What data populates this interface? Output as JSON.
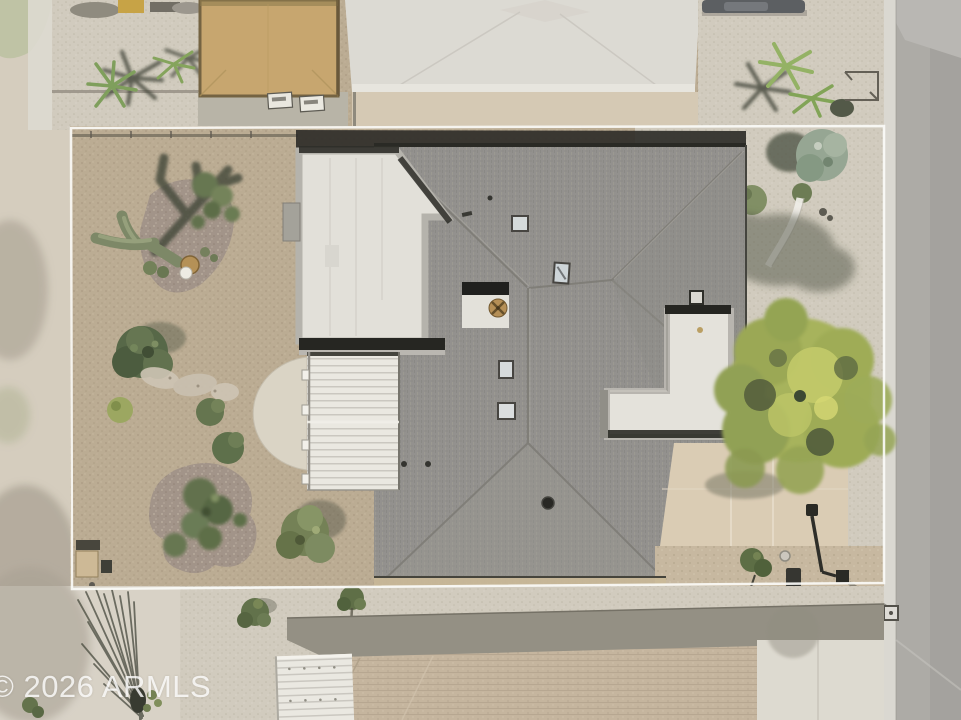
{
  "watermark": {
    "text": "© 2026 ARMLS",
    "color": "#ffffff"
  },
  "scene": {
    "type": "aerial-drone-photo",
    "subject": "Top-down aerial view of a single-story desert home with a gray shingle hip roof, white flat-roof additions and corrugated patio covers, xeriscaped gravel yard with a saguaro cactus and a large palo verde tree, outlined by a white property-boundary overlay; street along the right edge and neighboring homes above and below",
    "overlay": {
      "property_line_color": "#ffffff"
    },
    "palette": {
      "dirt_yard": "#b8a88f",
      "white_gravel": "#cfc9bc",
      "gravel_bed_mauve": "#9d8e83",
      "roof_shingle_gray": "#8e8c89",
      "flat_roof_white": "#e1dfd9",
      "patio_concrete": "#d9cab2",
      "street_asphalt": "#a9a7a3",
      "curb": "#d8d6d0",
      "cactus_green": "#778260",
      "tree_dark_green": "#4f6040",
      "palo_verde_green": "#a3af55",
      "neighbor_roof_tan": "#c2b19a",
      "outbuilding_tan": "#c4a269",
      "shadow": "#3b3f33"
    },
    "features": [
      "property-boundary-outline",
      "main-house-hip-roof",
      "casita-flat-roof",
      "corrugated-patio-cover",
      "rooftop-skylights",
      "atrium-vent-fan",
      "saguaro-cactus-with-shadow",
      "desert-gravel-landscaping",
      "palo-verde-tree",
      "curved-garden-path",
      "yard-lamp",
      "rear-concrete-patio",
      "street-with-curb",
      "neighbor-house-top",
      "neighbor-house-bottom",
      "tan-outbuilding",
      "palm-trees",
      "parked-car",
      "watermark"
    ]
  }
}
